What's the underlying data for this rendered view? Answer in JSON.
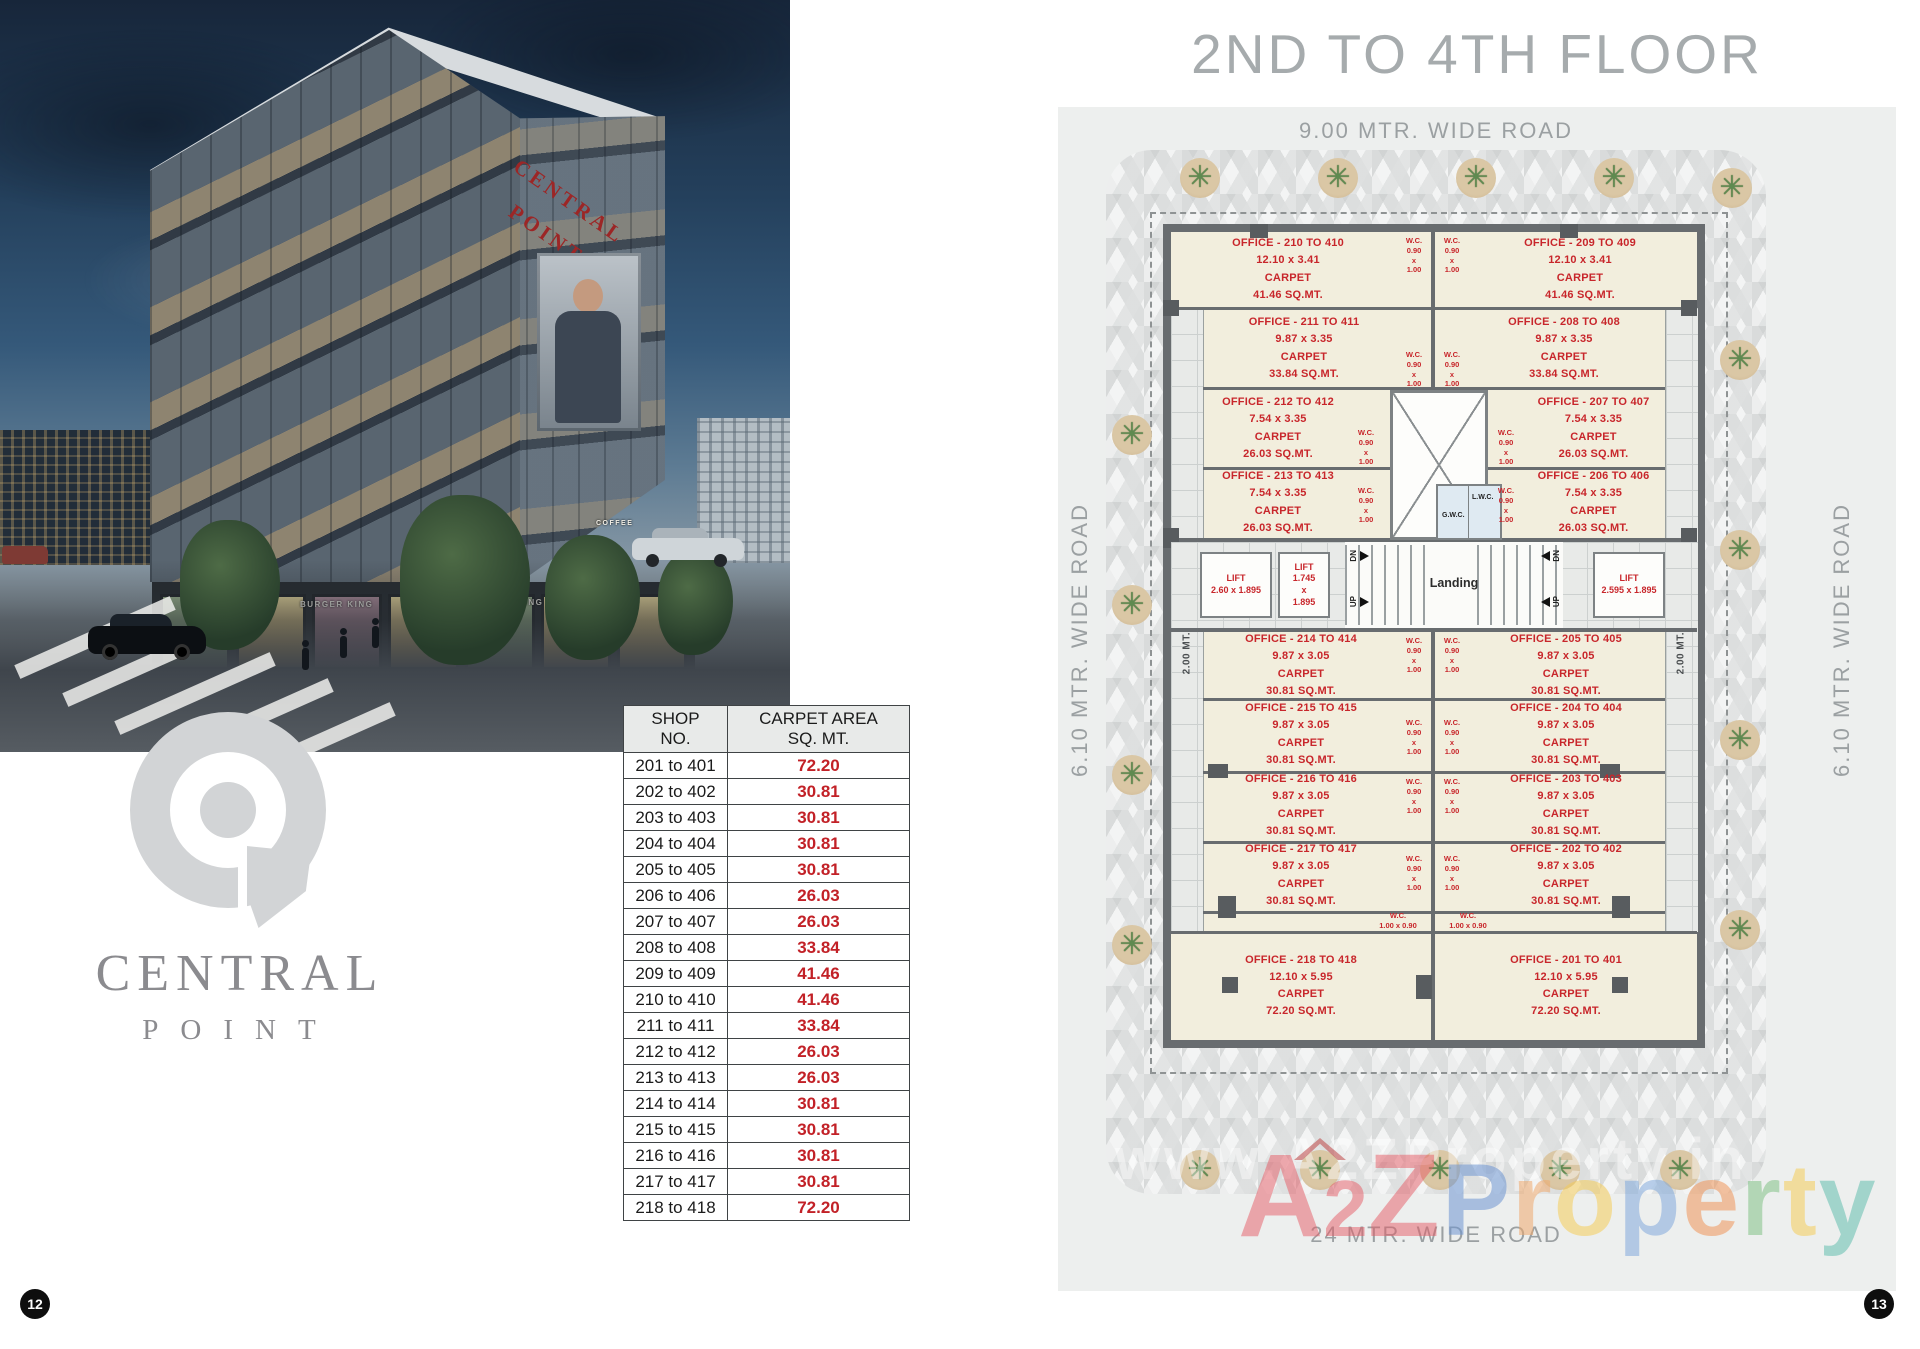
{
  "page": {
    "left_number": "12",
    "right_number": "13"
  },
  "left": {
    "photo": {
      "building_sign": "CENTRAL\nPOINT",
      "shop_signs": [
        "BURGER KING",
        "BURGER KING",
        "ARMANI",
        "COFFEE"
      ]
    },
    "logo": {
      "line1": "CENTRAL",
      "line2": "POINT"
    },
    "table": {
      "h_shop": "SHOP\nNO.",
      "h_area": "CARPET AREA\nSQ. MT.",
      "rows": [
        {
          "shop": "201 to 401",
          "area": "72.20"
        },
        {
          "shop": "202 to 402",
          "area": "30.81"
        },
        {
          "shop": "203 to 403",
          "area": "30.81"
        },
        {
          "shop": "204 to 404",
          "area": "30.81"
        },
        {
          "shop": "205 to 405",
          "area": "30.81"
        },
        {
          "shop": "206 to 406",
          "area": "26.03"
        },
        {
          "shop": "207 to 407",
          "area": "26.03"
        },
        {
          "shop": "208 to 408",
          "area": "33.84"
        },
        {
          "shop": "209 to 409",
          "area": "41.46"
        },
        {
          "shop": "210 to 410",
          "area": "41.46"
        },
        {
          "shop": "211 to 411",
          "area": "33.84"
        },
        {
          "shop": "212 to 412",
          "area": "26.03"
        },
        {
          "shop": "213 to 413",
          "area": "26.03"
        },
        {
          "shop": "214 to 414",
          "area": "30.81"
        },
        {
          "shop": "215 to 415",
          "area": "30.81"
        },
        {
          "shop": "216 to 416",
          "area": "30.81"
        },
        {
          "shop": "217 to 417",
          "area": "30.81"
        },
        {
          "shop": "218 to 418",
          "area": "72.20"
        }
      ]
    }
  },
  "plan": {
    "title": "2ND TO 4TH FLOOR",
    "road_top": "9.00 MTR. WIDE ROAD",
    "road_bottom": "24 MTR. WIDE ROAD",
    "road_left": "6.10 MTR. WIDE ROAD",
    "road_right": "6.10 MTR. WIDE ROAD",
    "passage_left": "2.00 MT. WIDE PASSAGE",
    "passage_right": "2.00 MT. WIDE PASSAGE",
    "landing": "Landing",
    "stairs": {
      "dn": "DN",
      "up": "UP"
    },
    "core": {
      "gwc": "G.W.C.",
      "lwc": "L.W.C."
    },
    "wc_v": [
      "W.C.",
      "0.90",
      "x",
      "1.00"
    ],
    "wc_h": [
      "W.C.",
      "1.00 x 0.90"
    ],
    "lifts": {
      "l1": [
        "LIFT",
        "2.60 x 1.895"
      ],
      "l2": [
        "LIFT",
        "1.745",
        "x",
        "1.895"
      ],
      "l3": [
        "LIFT",
        "2.595 x 1.895"
      ]
    },
    "offices": {
      "o210": [
        "OFFICE - 210 TO 410",
        "12.10 x 3.41",
        "CARPET",
        "41.46 SQ.MT."
      ],
      "o209": [
        "OFFICE - 209 TO 409",
        "12.10 x 3.41",
        "CARPET",
        "41.46 SQ.MT."
      ],
      "o211": [
        "OFFICE - 211 TO 411",
        "9.87 x 3.35",
        "CARPET",
        "33.84 SQ.MT."
      ],
      "o208": [
        "OFFICE - 208 TO 408",
        "9.87 x 3.35",
        "CARPET",
        "33.84 SQ.MT."
      ],
      "o212": [
        "OFFICE - 212 TO 412",
        "7.54 x 3.35",
        "CARPET",
        "26.03 SQ.MT."
      ],
      "o207": [
        "OFFICE - 207 TO 407",
        "7.54 x 3.35",
        "CARPET",
        "26.03 SQ.MT."
      ],
      "o213": [
        "OFFICE - 213 TO 413",
        "7.54 x 3.35",
        "CARPET",
        "26.03 SQ.MT."
      ],
      "o206": [
        "OFFICE - 206 TO 406",
        "7.54 x 3.35",
        "CARPET",
        "26.03 SQ.MT."
      ],
      "o214": [
        "OFFICE - 214 TO 414",
        "9.87 x 3.05",
        "CARPET",
        "30.81 SQ.MT."
      ],
      "o205": [
        "OFFICE - 205 TO 405",
        "9.87 x 3.05",
        "CARPET",
        "30.81 SQ.MT."
      ],
      "o215": [
        "OFFICE - 215 TO 415",
        "9.87 x 3.05",
        "CARPET",
        "30.81 SQ.MT."
      ],
      "o204": [
        "OFFICE - 204 TO 404",
        "9.87 x 3.05",
        "CARPET",
        "30.81 SQ.MT."
      ],
      "o216": [
        "OFFICE - 216 TO 416",
        "9.87 x 3.05",
        "CARPET",
        "30.81 SQ.MT."
      ],
      "o203": [
        "OFFICE - 203 TO 403",
        "9.87 x 3.05",
        "CARPET",
        "30.81 SQ.MT."
      ],
      "o217": [
        "OFFICE - 217 TO 417",
        "9.87 x 3.05",
        "CARPET",
        "30.81 SQ.MT."
      ],
      "o202": [
        "OFFICE - 202 TO 402",
        "9.87 x 3.05",
        "CARPET",
        "30.81 SQ.MT."
      ],
      "o218": [
        "OFFICE - 218 TO 418",
        "12.10 x 5.95",
        "CARPET",
        "72.20 SQ.MT."
      ],
      "o201": [
        "OFFICE - 201 TO 401",
        "12.10 x 5.95",
        "CARPET",
        "72.20 SQ.MT."
      ]
    },
    "watermark": {
      "url": "www.A2ZProperty.in",
      "a": "A",
      "two": "2",
      "z": "Z",
      "rest": "Property",
      "letter_colors": [
        "#6e96d2",
        "#f0aa6e",
        "#f5cd5a",
        "#82aadc",
        "#f0965a",
        "#82c387",
        "#f5cd5a",
        "#64bfaf"
      ]
    },
    "colors": {
      "label_red": "#c8262b",
      "wall_gray": "#686c6f",
      "office_fill": "#f2eedd",
      "panel_gray": "#edefee",
      "table_value_red": "#c22127",
      "logo_gray": "#d2d4d6"
    }
  }
}
